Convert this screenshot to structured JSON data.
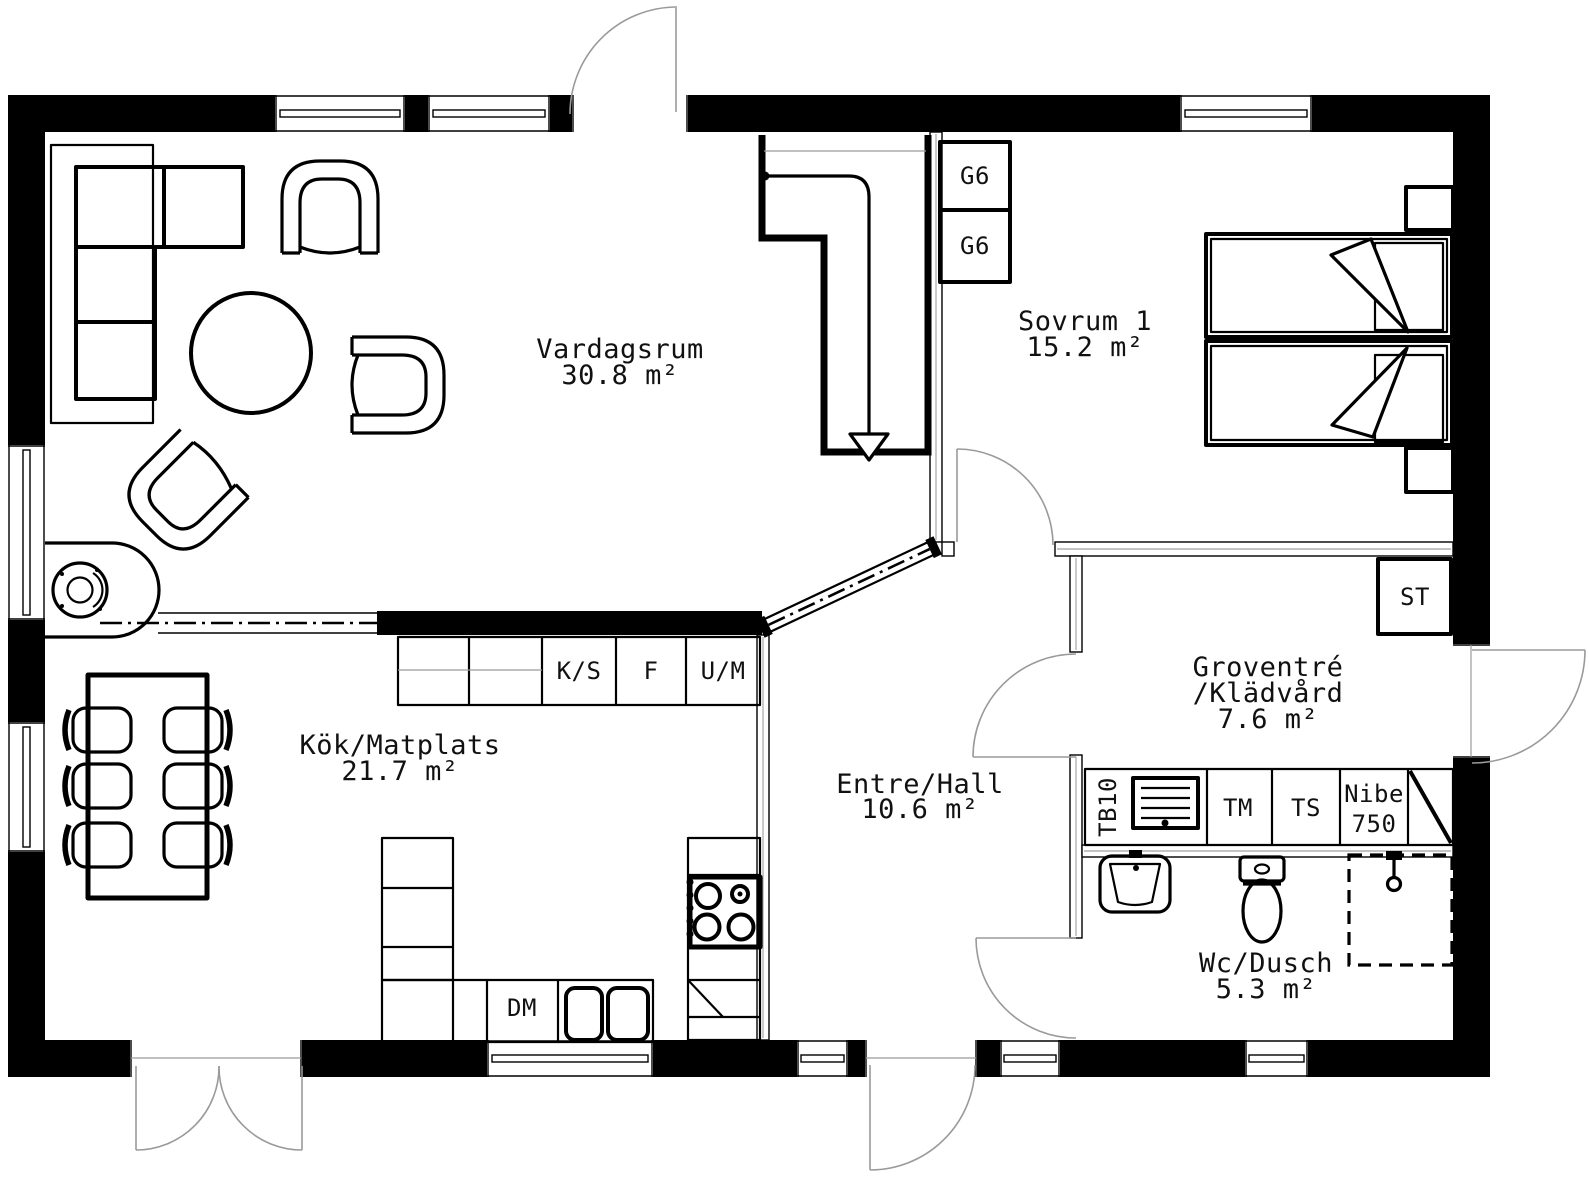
{
  "rooms": [
    {
      "name": "Vardagsrum",
      "area": "30.8 m²"
    },
    {
      "name": "Sovrum 1",
      "area": "15.2 m²"
    },
    {
      "name": "Kök/Matplats",
      "area": "21.7 m²"
    },
    {
      "name": "Entre/Hall",
      "area": "10.6 m²"
    },
    {
      "name": "Groventré",
      "name2": "/Klädvård",
      "area": "7.6 m²"
    },
    {
      "name": "Wc/Dusch",
      "area": "5.3 m²"
    }
  ],
  "fixtures": {
    "wardrobe_top": "G6",
    "wardrobe_bottom": "G6",
    "fridge": "K/S",
    "freezer": "F",
    "oven_micro": "U/M",
    "dishwasher": "DM",
    "laundry_bench": "TB10",
    "washing_machine": "TM",
    "drying_cabinet": "TS",
    "water_heater_line1": "Nibe",
    "water_heater_line2": "750",
    "cleaning_cabinet": "ST"
  },
  "colors": {
    "walls": "#000000",
    "door_swing": "#9a9a9a",
    "background": "#ffffff"
  }
}
